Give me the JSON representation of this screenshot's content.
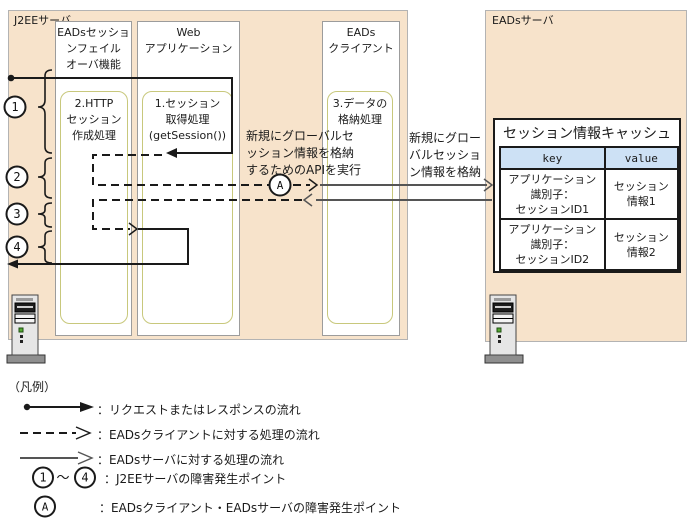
{
  "colors": {
    "container_bg": "#f7e3cb",
    "container_border": "#b3b3b3",
    "column_border": "#9c9c9c",
    "process_border": "#c8c87c",
    "table_header_bg": "#cde1f5",
    "arrow_black": "#1a1a1a",
    "arrow_gray": "#555555"
  },
  "j2ee": {
    "label": "J2EEサーバ",
    "failover_column": {
      "title": "EADsセッショ\nンフェイル\nオーバ機能",
      "process": "2.HTTP\nセッション\n作成処理"
    },
    "webapp_column": {
      "title": "Web\nアプリケーション",
      "process": "1.セッション\n取得処理\n(getSession())"
    },
    "eads_client_column": {
      "title": "EADs\nクライアント",
      "process": "3.データの\n格納処理"
    }
  },
  "eads_server": {
    "label": "EADsサーバ",
    "cache": {
      "title": "セッション情報キャッシュ",
      "headers": [
        "key",
        "value"
      ],
      "rows": [
        {
          "key": "アプリケーション\n識別子：\nセッションID1",
          "value": "セッション\n情報1"
        },
        {
          "key": "アプリケーション\n識別子：\nセッションID2",
          "value": "セッション\n情報2"
        }
      ]
    }
  },
  "annotations": {
    "api_call": "新規にグローバルセ\nッション情報を格納\nするためのAPIを実行",
    "store_info": "新規にグロー\nバルセッショ\nン情報を格納"
  },
  "markers": {
    "p1": "1",
    "p2": "2",
    "p3": "3",
    "p4": "4",
    "a": "A",
    "range": "～"
  },
  "legend": {
    "title": "（凡例）",
    "items": [
      {
        "text": "：リクエストまたはレスポンスの流れ"
      },
      {
        "text": "：EADsクライアントに対する処理の流れ"
      },
      {
        "text": "：EADsサーバに対する処理の流れ"
      },
      {
        "text": "：J2EEサーバの障害発生ポイント"
      },
      {
        "text": "：EADsクライアント・EADsサーバの障害発生ポイント"
      }
    ]
  }
}
